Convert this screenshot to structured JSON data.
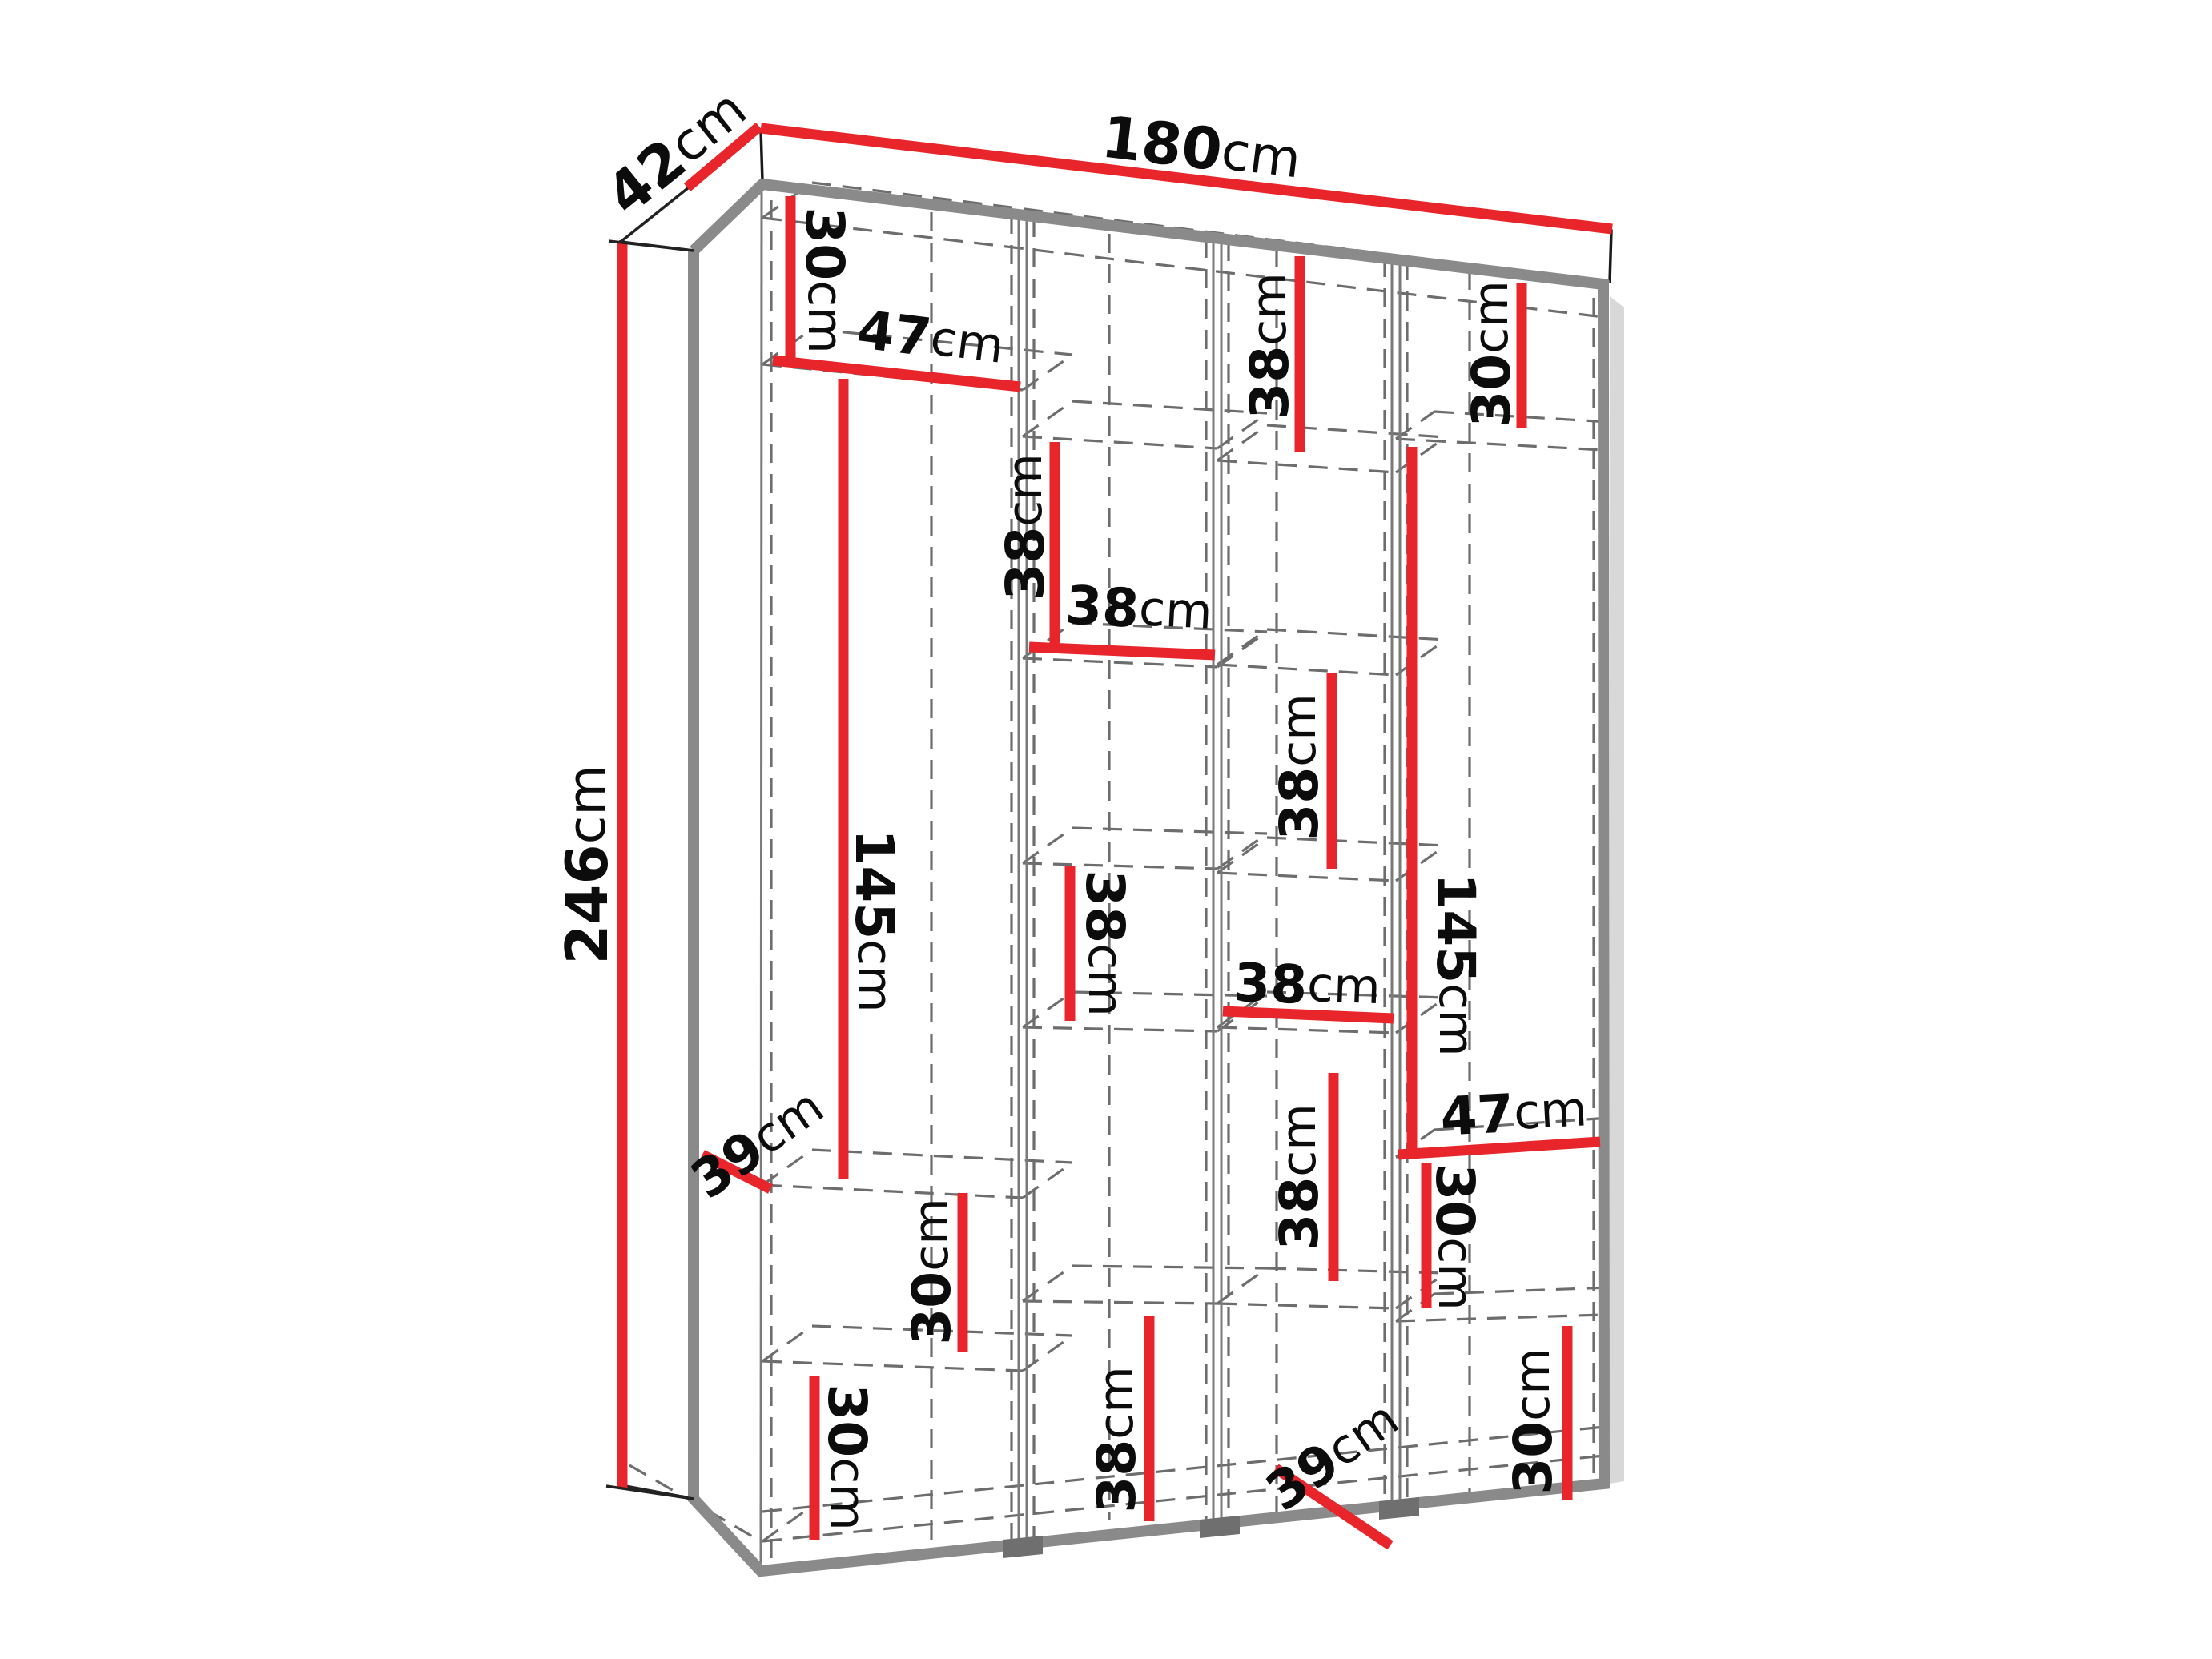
{
  "diagram": {
    "type": "furniture-dimension-diagram",
    "subject": "Wardrobe carcass shown in perspective with internal shelf dimensions",
    "units": "cm",
    "accent_color": "#e8252b",
    "edge_color": "#8a8a8a",
    "dash_color": "#6d6d6d",
    "overall": {
      "width": "180cm",
      "depth": "42cm",
      "height": "246cm"
    },
    "callouts_summary": [
      {
        "column": "overall",
        "kind": "width",
        "value": 180
      },
      {
        "column": "overall",
        "kind": "depth",
        "value": 42
      },
      {
        "column": "overall",
        "kind": "height",
        "value": 246
      },
      {
        "column": 1,
        "kind": "cell-height",
        "value": 30
      },
      {
        "column": 1,
        "kind": "column-width",
        "value": 47
      },
      {
        "column": 1,
        "kind": "cell-height",
        "value": 145
      },
      {
        "column": 1,
        "kind": "shelf-depth",
        "value": 39
      },
      {
        "column": 1,
        "kind": "cell-height",
        "value": 30
      },
      {
        "column": 1,
        "kind": "cell-height",
        "value": 30
      },
      {
        "column": 2,
        "kind": "cell-height",
        "value": 38
      },
      {
        "column": 2,
        "kind": "column-width",
        "value": 38
      },
      {
        "column": 2,
        "kind": "cell-height",
        "value": 38
      },
      {
        "column": 2,
        "kind": "cell-height",
        "value": 38
      },
      {
        "column": 3,
        "kind": "cell-height",
        "value": 38
      },
      {
        "column": 3,
        "kind": "cell-height",
        "value": 38
      },
      {
        "column": 3,
        "kind": "column-width",
        "value": 38
      },
      {
        "column": 3,
        "kind": "cell-height",
        "value": 38
      },
      {
        "column": 3,
        "kind": "shelf-depth",
        "value": 39
      },
      {
        "column": 4,
        "kind": "cell-height",
        "value": 30
      },
      {
        "column": 4,
        "kind": "cell-height",
        "value": 145
      },
      {
        "column": 4,
        "kind": "column-width",
        "value": 47
      },
      {
        "column": 4,
        "kind": "cell-height",
        "value": 30
      },
      {
        "column": 4,
        "kind": "cell-height",
        "value": 30
      }
    ],
    "labels": {
      "w180": {
        "v": "180",
        "u": "cm"
      },
      "d42": {
        "v": "42",
        "u": "cm"
      },
      "h246": {
        "v": "246",
        "u": "cm"
      },
      "c1_30_top": {
        "v": "30",
        "u": "cm"
      },
      "c1_47": {
        "v": "47",
        "u": "cm"
      },
      "c1_145": {
        "v": "145",
        "u": "cm"
      },
      "c1_39": {
        "v": "39",
        "u": "cm"
      },
      "c1_30_mid": {
        "v": "30",
        "u": "cm"
      },
      "c1_30_bot": {
        "v": "30",
        "u": "cm"
      },
      "c2_38_top": {
        "v": "38",
        "u": "cm"
      },
      "c2_38_w": {
        "v": "38",
        "u": "cm"
      },
      "c2_38_mid": {
        "v": "38",
        "u": "cm"
      },
      "c2_38_bot": {
        "v": "38",
        "u": "cm"
      },
      "c3_38_top": {
        "v": "38",
        "u": "cm"
      },
      "c3_38_u": {
        "v": "38",
        "u": "cm"
      },
      "c3_38_w": {
        "v": "38",
        "u": "cm"
      },
      "c3_38_mid": {
        "v": "38",
        "u": "cm"
      },
      "c3_39": {
        "v": "39",
        "u": "cm"
      },
      "c4_30_top": {
        "v": "30",
        "u": "cm"
      },
      "c4_145": {
        "v": "145",
        "u": "cm"
      },
      "c4_47": {
        "v": "47",
        "u": "cm"
      },
      "c4_30_mid": {
        "v": "30",
        "u": "cm"
      },
      "c4_30_bot": {
        "v": "30",
        "u": "cm"
      }
    }
  }
}
